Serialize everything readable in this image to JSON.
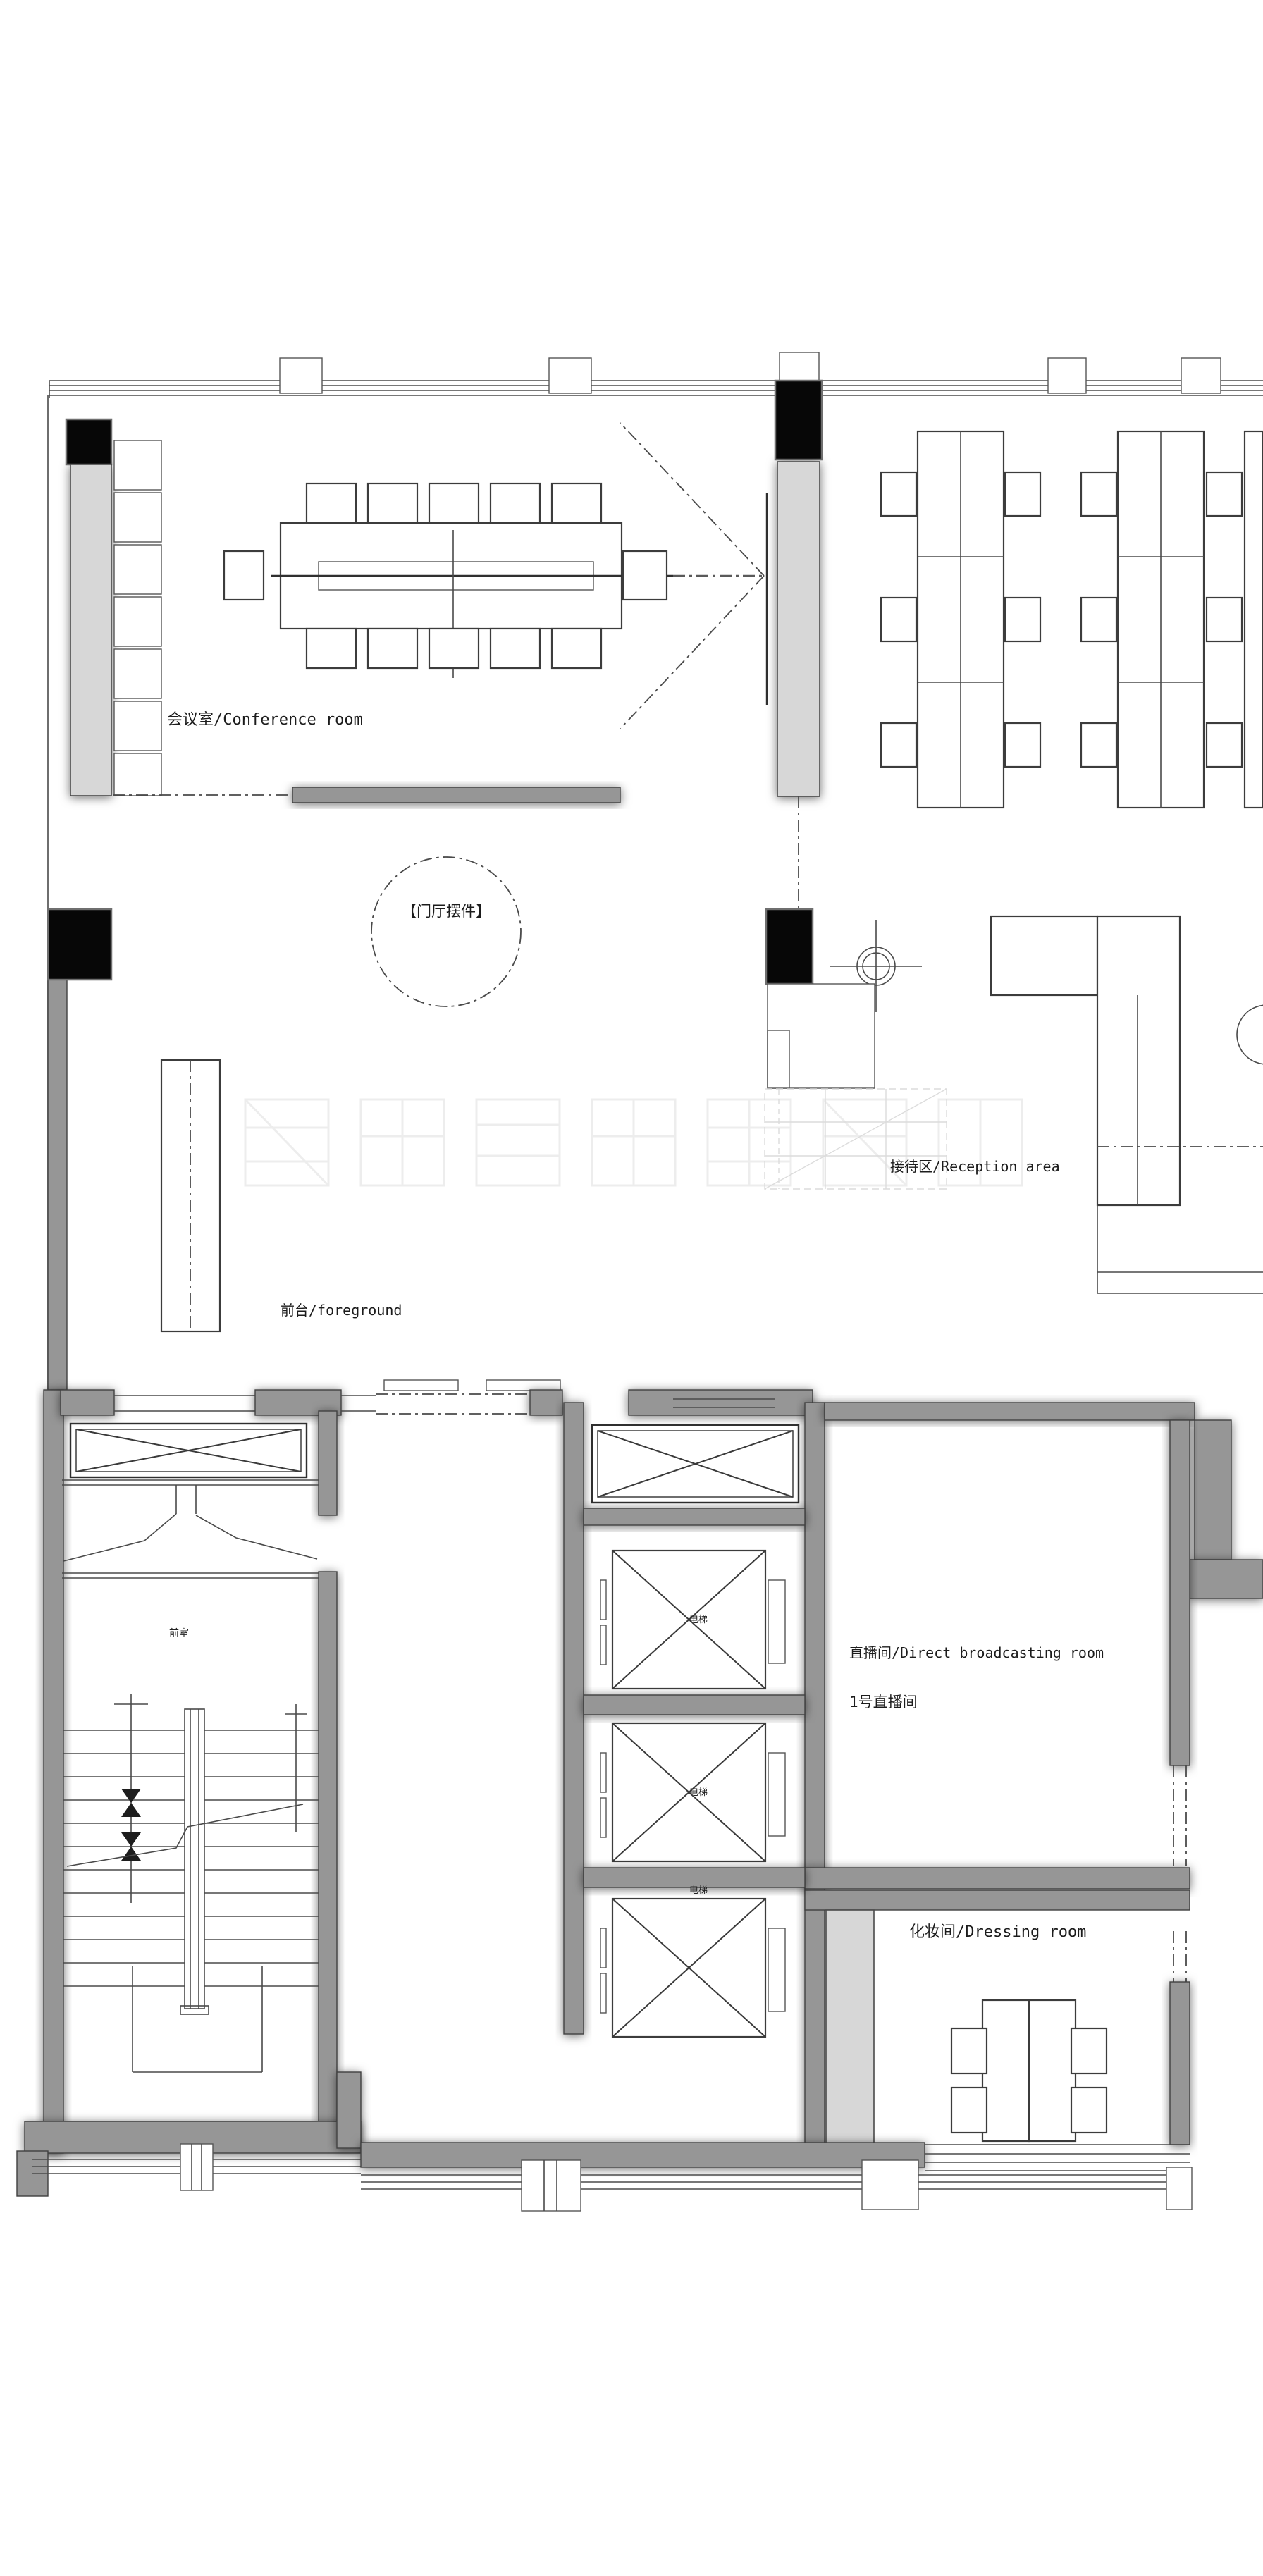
{
  "drawing": {
    "kind": "architectural floor plan",
    "rooms": {
      "conference": {
        "label": "会议室/Conference room"
      },
      "ornament": {
        "label": "【门厅摆件】"
      },
      "reception": {
        "label": "接待区/Reception area"
      },
      "front_desk": {
        "label": "前台/foreground"
      },
      "broadcast": {
        "label": "直播间/Direct broadcasting room",
        "sublabel": "1号直播间"
      },
      "dressing": {
        "label": "化妆间/Dressing room"
      },
      "vestibule": {
        "label": "前室"
      }
    },
    "elevator": {
      "label": "电梯"
    },
    "colors": {
      "background": "#ffffff",
      "wall_gray": "#969696",
      "shaft_light": "#d7d7d7",
      "column_black": "#070707",
      "line_dark": "#4a4a4a"
    },
    "furniture_counts": {
      "conference_chairs": 12,
      "wall_cabinets": 7,
      "workstation_clusters": 2,
      "elevators": 3,
      "dressing_chairs": 4
    }
  }
}
